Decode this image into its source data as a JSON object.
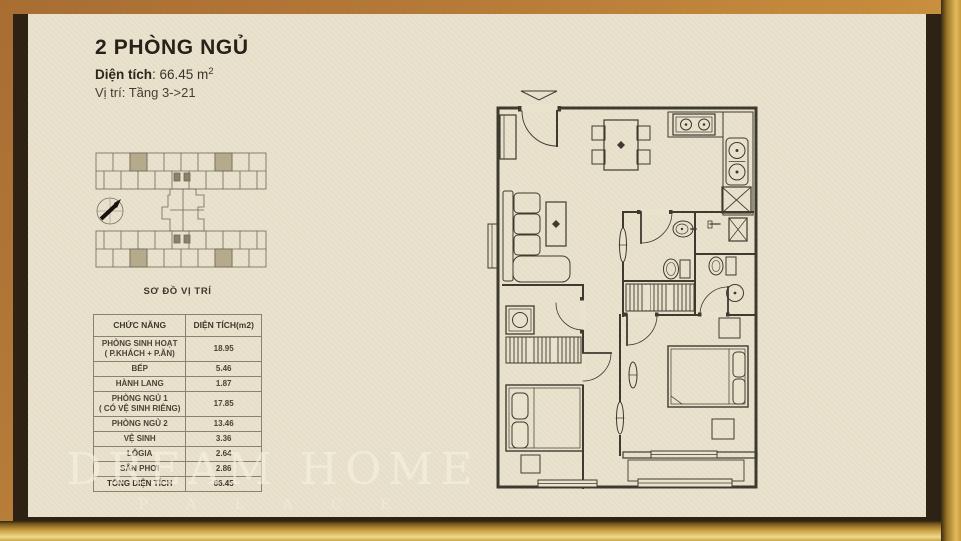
{
  "header": {
    "title": "2 PHÒNG NGỦ",
    "area_label": "Diện tích",
    "area_value": ": 66.45 m",
    "area_sup": "2",
    "location": "Vị trí: Tầng  3->21"
  },
  "site_plan": {
    "caption": "SƠ ĐỒ VỊ TRÍ",
    "highlight_color": "#b6aa8d"
  },
  "area_table": {
    "columns": [
      "CHỨC NĂNG",
      "DIỆN TÍCH(m2)"
    ],
    "rows": [
      {
        "name": "PHÒNG SINH HOẠT",
        "name2": "( P.KHÁCH + P.ĂN)",
        "value": "18.95"
      },
      {
        "name": "BẾP",
        "value": "5.46"
      },
      {
        "name": "HÀNH LANG",
        "value": "1.87"
      },
      {
        "name": "PHÒNG NGỦ 1",
        "name2": "( CÓ VỆ SINH RIÊNG)",
        "value": "17.85"
      },
      {
        "name": "PHÒNG NGỦ 2",
        "value": "13.46"
      },
      {
        "name": "VỆ SINH",
        "value": "3.36"
      },
      {
        "name": "LÔGIA",
        "value": "2.64"
      },
      {
        "name": "SÂN PHƠI",
        "value": "2.86"
      },
      {
        "name": "TỔNG DIỆN TÍCH",
        "value": "66.45"
      }
    ]
  },
  "watermark": {
    "line1": "DREAM HOME",
    "line2": "P A L A C E"
  },
  "colors": {
    "paper": "#e9e2cd",
    "frame_bronze": "#b57a38",
    "frame_gold_highlight": "#f0d88c",
    "frame_inner_dark": "#2d2214",
    "plan_line": "#3e3a30"
  }
}
